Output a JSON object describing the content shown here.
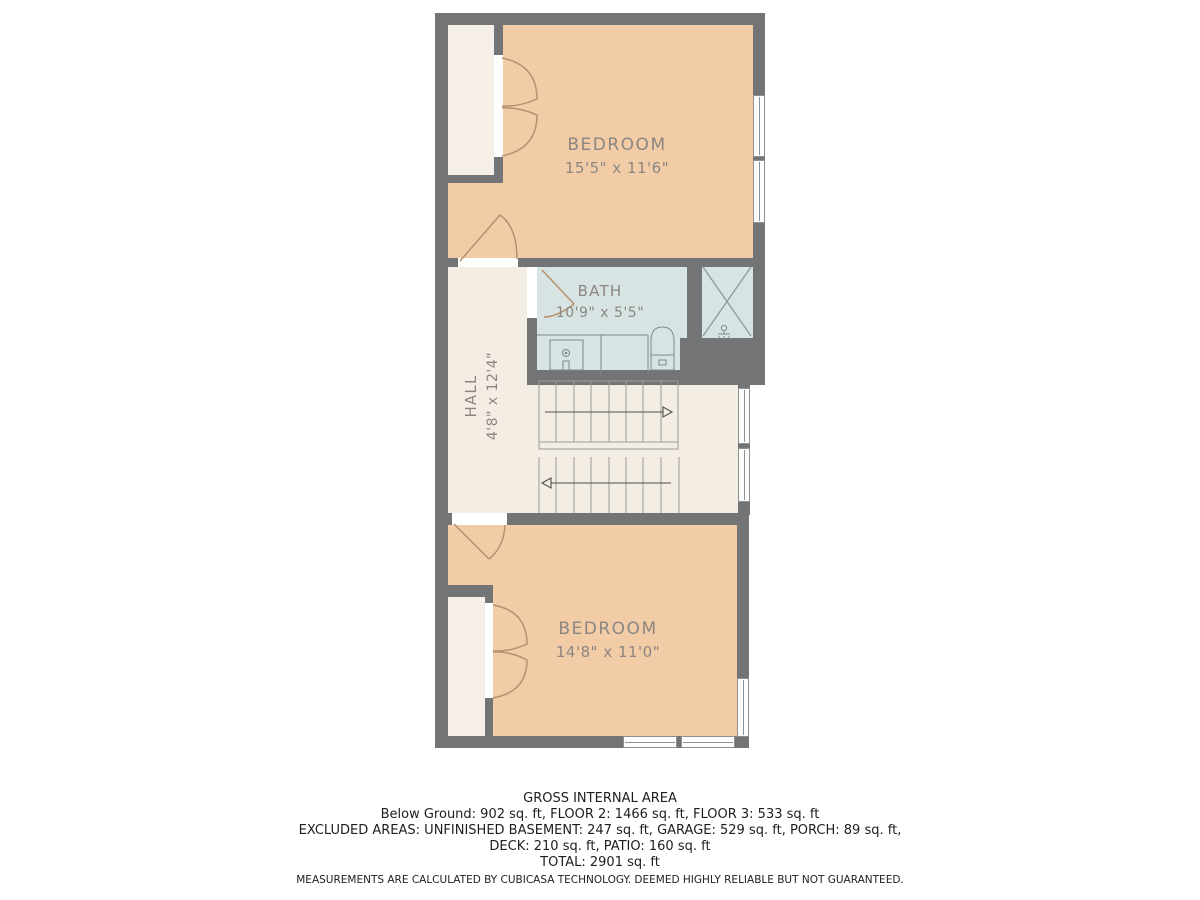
{
  "plan": {
    "rooms": [
      {
        "id": "bedroom-1",
        "label": "BEDROOM",
        "dims": "15'5\" x 11'6\""
      },
      {
        "id": "bath",
        "label": "BATH",
        "dims": "10'9\" x 5'5\""
      },
      {
        "id": "hall",
        "label": "HALL",
        "dims": "4'8\" x 12'4\""
      },
      {
        "id": "bedroom-2",
        "label": "BEDROOM",
        "dims": "14'8\" x 11'0\""
      }
    ]
  },
  "colors": {
    "wall": "#727476",
    "peach": "#f1cca7",
    "cream": "#f5efe7",
    "bath": "#d7e4e3",
    "doorline": "#b6916d",
    "labeltxt": "#8c8681"
  },
  "footer": {
    "title": "GROSS INTERNAL AREA",
    "line1": "Below Ground: 902 sq. ft, FLOOR 2: 1466 sq. ft, FLOOR 3: 533 sq. ft",
    "line2": "EXCLUDED AREAS: UNFINISHED BASEMENT: 247 sq. ft, GARAGE: 529 sq. ft, PORCH: 89 sq. ft,",
    "line3": "DECK: 210 sq. ft, PATIO: 160 sq. ft",
    "total": "TOTAL: 2901 sq. ft",
    "disclaimer": "MEASUREMENTS ARE CALCULATED BY CUBICASA TECHNOLOGY. DEEMED HIGHLY RELIABLE BUT NOT GUARANTEED."
  }
}
